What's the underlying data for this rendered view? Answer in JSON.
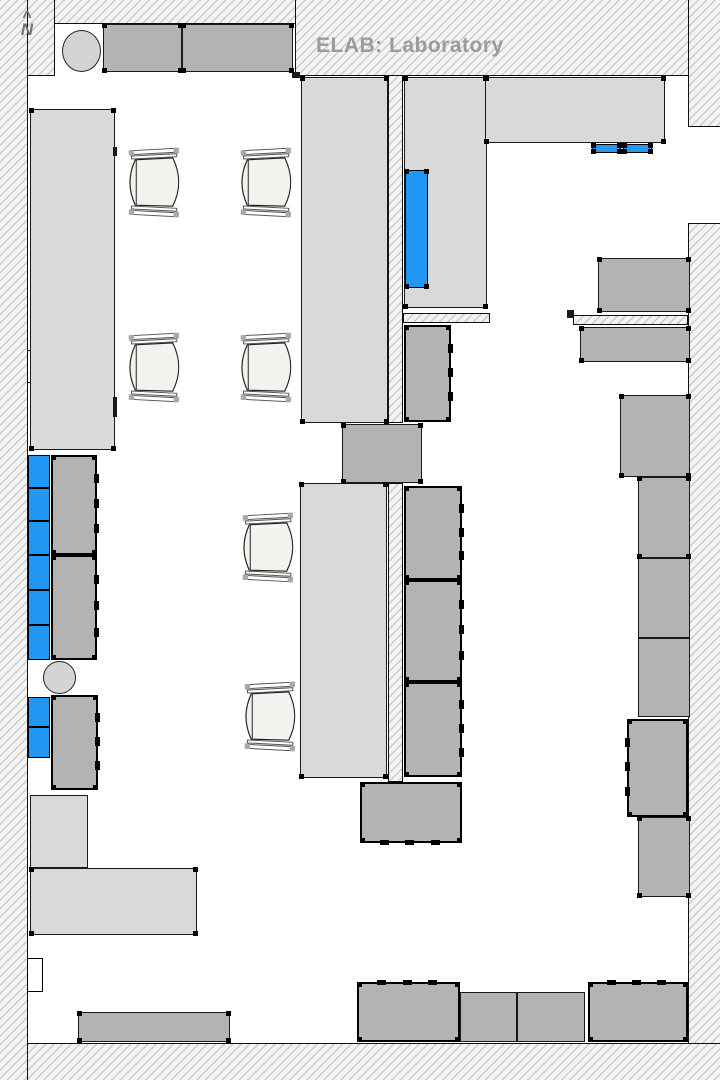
{
  "title": "ELAB: Laboratory",
  "north_label": "N",
  "north_caret": "^",
  "colors": {
    "highlight_blue": "#2196f3",
    "counter_light": "#d9d9d9",
    "counter_dark": "#b3b3b3",
    "wall_hatch_line": "#cbcbcb",
    "title_gray": "#9b9b9b"
  },
  "floorplan": {
    "layers": [
      {
        "cls": "hatch",
        "items": [
          {
            "name": "wall-left",
            "rect": [
              0,
              0,
              28,
              1080
            ],
            "b": [
              "right"
            ]
          },
          {
            "name": "wall-top-left-block",
            "rect": [
              28,
              0,
              27,
              76
            ],
            "b": [
              "right",
              "bottom"
            ]
          },
          {
            "name": "wall-top-thin",
            "rect": [
              55,
              0,
              242,
              24
            ],
            "b": [
              "bottom"
            ]
          },
          {
            "name": "wall-top-main",
            "rect": [
              295,
              0,
              393,
              76
            ],
            "b": [
              "left",
              "bottom"
            ]
          },
          {
            "name": "wall-top-right",
            "rect": [
              688,
              0,
              32,
              127
            ],
            "b": [
              "left",
              "bottom"
            ]
          },
          {
            "name": "wall-right",
            "rect": [
              688,
              223,
              32,
              857
            ],
            "b": [
              "left",
              "top"
            ]
          },
          {
            "name": "wall-bottom",
            "rect": [
              28,
              1043,
              692,
              37
            ],
            "b": [
              "top"
            ]
          },
          {
            "name": "inner-wall-vertical-upper",
            "rect": [
              388,
              76,
              15,
              347
            ],
            "b": [
              "left",
              "right",
              "bottom"
            ]
          },
          {
            "name": "inner-wall-vertical-lower",
            "rect": [
              388,
              483,
              15,
              299
            ],
            "b": [
              "left",
              "right",
              "top",
              "bottom"
            ]
          },
          {
            "name": "inner-wall-horizontal-left",
            "rect": [
              403,
              313,
              87,
              10
            ],
            "b": [
              "left",
              "right",
              "top",
              "bottom"
            ]
          },
          {
            "name": "inner-wall-horizontal-right",
            "rect": [
              573,
              315,
              115,
              10
            ],
            "b": [
              "left",
              "right",
              "top",
              "bottom"
            ]
          }
        ]
      },
      {
        "cls": "notch",
        "items": [
          {
            "name": "door-recess-upper-left",
            "rect": [
              27,
              350,
              16,
              33
            ]
          },
          {
            "name": "door-recess-lower-left",
            "rect": [
              27,
              958,
              16,
              34
            ]
          }
        ]
      },
      {
        "cls": "light",
        "items": [
          {
            "name": "counter-west",
            "rect": [
              30,
              109,
              85,
              341
            ],
            "dots": true
          },
          {
            "name": "table-north-center",
            "rect": [
              301,
              77,
              87,
              346
            ],
            "dots": true
          },
          {
            "name": "cabinet-north-b",
            "rect": [
              404,
              77,
              83,
              231
            ],
            "dots": true
          },
          {
            "name": "counter-north-east",
            "rect": [
              485,
              77,
              180,
              66
            ],
            "dots": true
          },
          {
            "name": "table-mid-center",
            "rect": [
              300,
              483,
              87,
              295
            ],
            "dots": true
          },
          {
            "name": "storage-southwest-a",
            "rect": [
              30,
              795,
              58,
              73
            ]
          },
          {
            "name": "storage-southwest-b",
            "rect": [
              30,
              868,
              167,
              67
            ],
            "dots": true
          }
        ]
      },
      {
        "cls": "dark",
        "items": [
          {
            "name": "alcove-counter-1",
            "rect": [
              103,
              24,
              79,
              48
            ],
            "dots": true
          },
          {
            "name": "alcove-counter-2",
            "rect": [
              182,
              24,
              111,
              48
            ],
            "dots": true
          },
          {
            "name": "connector-block",
            "rect": [
              342,
              424,
              80,
              59
            ],
            "dots": true
          },
          {
            "name": "bench-northeast-upper",
            "rect": [
              598,
              258,
              92,
              54
            ],
            "dots": true
          },
          {
            "name": "bench-northeast-lower",
            "rect": [
              580,
              327,
              110,
              35
            ],
            "dots": true
          },
          {
            "name": "cabinet-east-1",
            "rect": [
              620,
              395,
              70,
              82
            ],
            "dots": true
          },
          {
            "name": "cabinet-east-2",
            "rect": [
              638,
              477,
              52,
              81
            ],
            "dots": true
          },
          {
            "name": "cabinet-east-3",
            "rect": [
              638,
              558,
              52,
              80
            ]
          },
          {
            "name": "cabinet-east-4",
            "rect": [
              638,
              638,
              52,
              79
            ]
          },
          {
            "name": "cabinet-east-6",
            "rect": [
              638,
              817,
              52,
              80
            ],
            "dots": true
          },
          {
            "name": "bench-south-west",
            "rect": [
              78,
              1012,
              152,
              30
            ],
            "dots": true
          },
          {
            "name": "bench-south-1",
            "rect": [
              460,
              992,
              57,
              50
            ]
          },
          {
            "name": "bench-south-2",
            "rect": [
              517,
              992,
              68,
              50
            ]
          }
        ]
      },
      {
        "cls": "heavy",
        "items": [
          {
            "name": "equipment-module-north",
            "rect": [
              404,
              325,
              47,
              97
            ],
            "dots": true,
            "ticks": {
              "side": "right",
              "n": 3
            }
          },
          {
            "name": "equipment-module-center-1",
            "rect": [
              404,
              486,
              58,
              94
            ],
            "dots": true,
            "ticks": {
              "side": "right",
              "n": 3
            }
          },
          {
            "name": "equipment-module-center-2",
            "rect": [
              404,
              580,
              58,
              102
            ],
            "dots": true,
            "ticks": {
              "side": "right",
              "n": 3
            }
          },
          {
            "name": "equipment-module-center-3",
            "rect": [
              404,
              682,
              58,
              95
            ],
            "dots": true,
            "ticks": {
              "side": "right",
              "n": 3
            }
          },
          {
            "name": "equipment-module-center-4",
            "rect": [
              360,
              782,
              102,
              61
            ],
            "dots": true,
            "ticks": {
              "side": "bottom",
              "n": 3
            }
          },
          {
            "name": "equipment-module-west-1",
            "rect": [
              51,
              455,
              46,
              100
            ],
            "dots": true,
            "ticks": {
              "side": "right",
              "n": 3
            }
          },
          {
            "name": "equipment-module-west-2",
            "rect": [
              51,
              555,
              46,
              105
            ],
            "dots": true,
            "ticks": {
              "side": "right",
              "n": 3
            }
          },
          {
            "name": "equipment-module-west-3",
            "rect": [
              51,
              695,
              47,
              95
            ],
            "dots": true,
            "ticks": {
              "side": "right",
              "n": 3
            }
          },
          {
            "name": "equipment-cabinet-east-5",
            "rect": [
              627,
              719,
              61,
              98
            ],
            "dots": true,
            "ticks": {
              "side": "left",
              "n": 3
            }
          },
          {
            "name": "equipment-bench-south-a",
            "rect": [
              357,
              982,
              103,
              60
            ],
            "dots": true,
            "ticks": {
              "side": "top",
              "n": 3
            }
          },
          {
            "name": "equipment-bench-south-b",
            "rect": [
              588,
              982,
              100,
              60
            ],
            "dots": true,
            "ticks": {
              "side": "top",
              "n": 3
            }
          }
        ]
      },
      {
        "cls": "blue",
        "items": [
          {
            "name": "highlighted-equipment-main",
            "rect": [
              405,
              170,
              23,
              118
            ],
            "dots": true
          },
          {
            "name": "highlighted-equipment-ne-1",
            "rect": [
              592,
              144,
              29,
              9
            ],
            "dots": true
          },
          {
            "name": "highlighted-equipment-ne-2",
            "rect": [
              623,
              144,
              29,
              9
            ],
            "dots": true
          },
          {
            "name": "highlighted-unit-west-1",
            "rect": [
              28,
              455,
              22,
              33
            ]
          },
          {
            "name": "highlighted-unit-west-2",
            "rect": [
              28,
              488,
              22,
              33
            ]
          },
          {
            "name": "highlighted-unit-west-3",
            "rect": [
              28,
              521,
              22,
              34
            ]
          },
          {
            "name": "highlighted-unit-west-4",
            "rect": [
              28,
              555,
              22,
              35
            ]
          },
          {
            "name": "highlighted-unit-west-5",
            "rect": [
              28,
              590,
              22,
              35
            ]
          },
          {
            "name": "highlighted-unit-west-6",
            "rect": [
              28,
              625,
              22,
              35
            ]
          },
          {
            "name": "highlighted-unit-west-7",
            "rect": [
              28,
              697,
              22,
              30
            ]
          },
          {
            "name": "highlighted-unit-west-8",
            "rect": [
              28,
              727,
              22,
              31
            ]
          }
        ]
      },
      {
        "cls": "circle",
        "items": [
          {
            "name": "sink-circle-north",
            "rect": [
              62,
              30,
              39,
              42
            ]
          },
          {
            "name": "sink-circle-west",
            "rect": [
              43,
              661,
              33,
              33
            ]
          }
        ]
      },
      {
        "cls": "mark",
        "items": [
          {
            "name": "outlet-mark-counter-west-1",
            "rect": [
              113,
              147,
              4,
              9
            ]
          },
          {
            "name": "outlet-mark-counter-west-2",
            "rect": [
              113,
              397,
              4,
              20
            ]
          },
          {
            "name": "corner-mark-top-wall",
            "rect": [
              292,
              72,
              8,
              6
            ]
          },
          {
            "name": "door-jamb-mark",
            "rect": [
              567,
              310,
              7,
              8
            ]
          }
        ]
      }
    ],
    "chairs": [
      {
        "name": "chair-1",
        "rect": [
          126,
          147,
          56,
          71
        ]
      },
      {
        "name": "chair-2",
        "rect": [
          238,
          147,
          56,
          71
        ]
      },
      {
        "name": "chair-3",
        "rect": [
          126,
          332,
          56,
          71
        ]
      },
      {
        "name": "chair-4",
        "rect": [
          238,
          332,
          56,
          71
        ]
      },
      {
        "name": "chair-5",
        "rect": [
          240,
          512,
          56,
          71
        ]
      },
      {
        "name": "chair-6",
        "rect": [
          242,
          681,
          56,
          71
        ]
      }
    ]
  }
}
